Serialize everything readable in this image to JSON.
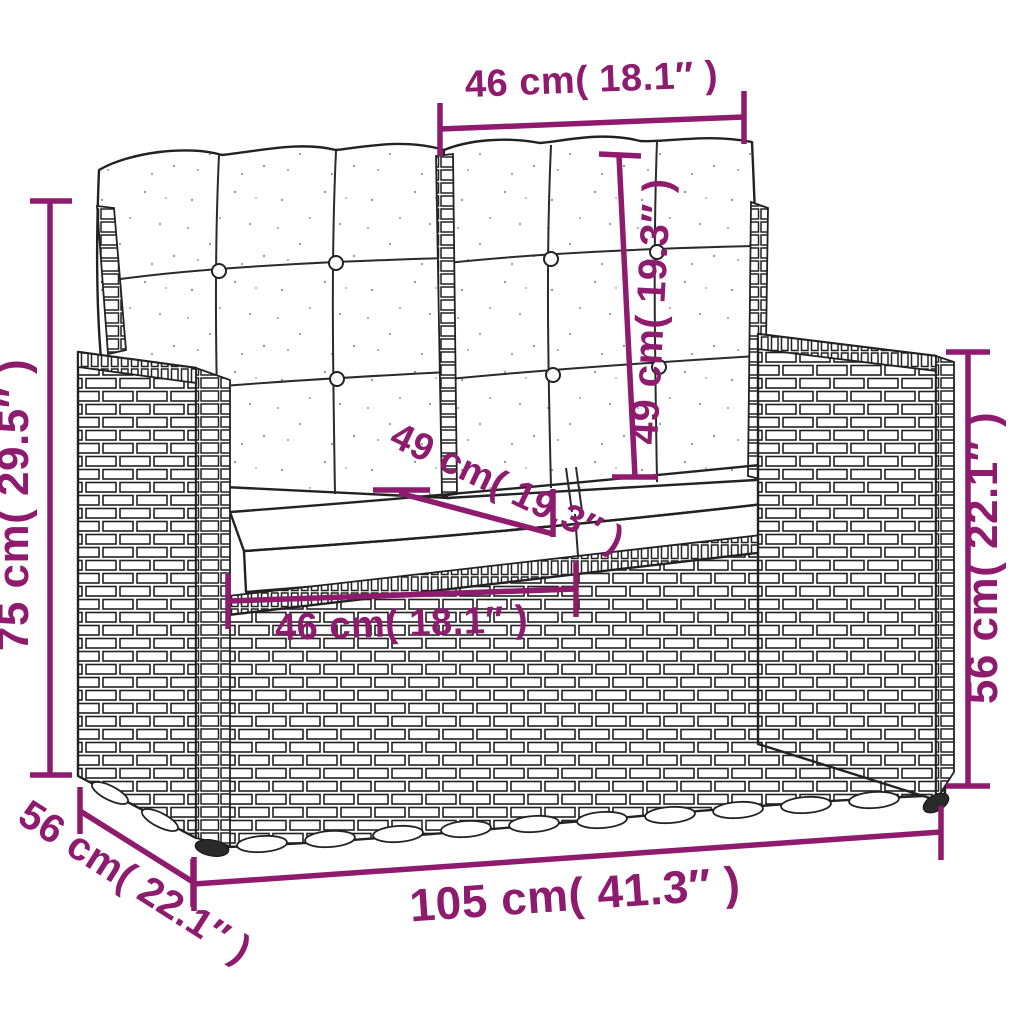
{
  "diagram": {
    "subject": "2-seater poly rattan garden bench with tufted back cushions and seat cushions",
    "style": "black line art with magenta dimension annotations on white background"
  },
  "colors": {
    "dimension_accent": "#8E1B6E",
    "line_art": "#222222",
    "background": "#FFFFFF"
  },
  "dimensions": {
    "back_cushion_width": {
      "label": "46 cm( 18.1″ )",
      "value_cm": 46,
      "value_in": 18.1
    },
    "back_cushion_height": {
      "label": "49 cm( 19.3″ )",
      "value_cm": 49,
      "value_in": 19.3
    },
    "overall_height": {
      "label": "75 cm( 29.5″ )",
      "value_cm": 75,
      "value_in": 29.5
    },
    "seat_depth": {
      "label": "49 cm( 19.3″ )",
      "value_cm": 49,
      "value_in": 19.3
    },
    "seat_width": {
      "label": "46 cm( 18.1″ )",
      "value_cm": 46,
      "value_in": 18.1
    },
    "armrest_height": {
      "label": "56 cm( 22.1″ )",
      "value_cm": 56,
      "value_in": 22.1
    },
    "overall_depth": {
      "label": "56 cm( 22.1″ )",
      "value_cm": 56,
      "value_in": 22.1
    },
    "overall_width": {
      "label": "105 cm( 41.3″ )",
      "value_cm": 105,
      "value_in": 41.3
    }
  }
}
